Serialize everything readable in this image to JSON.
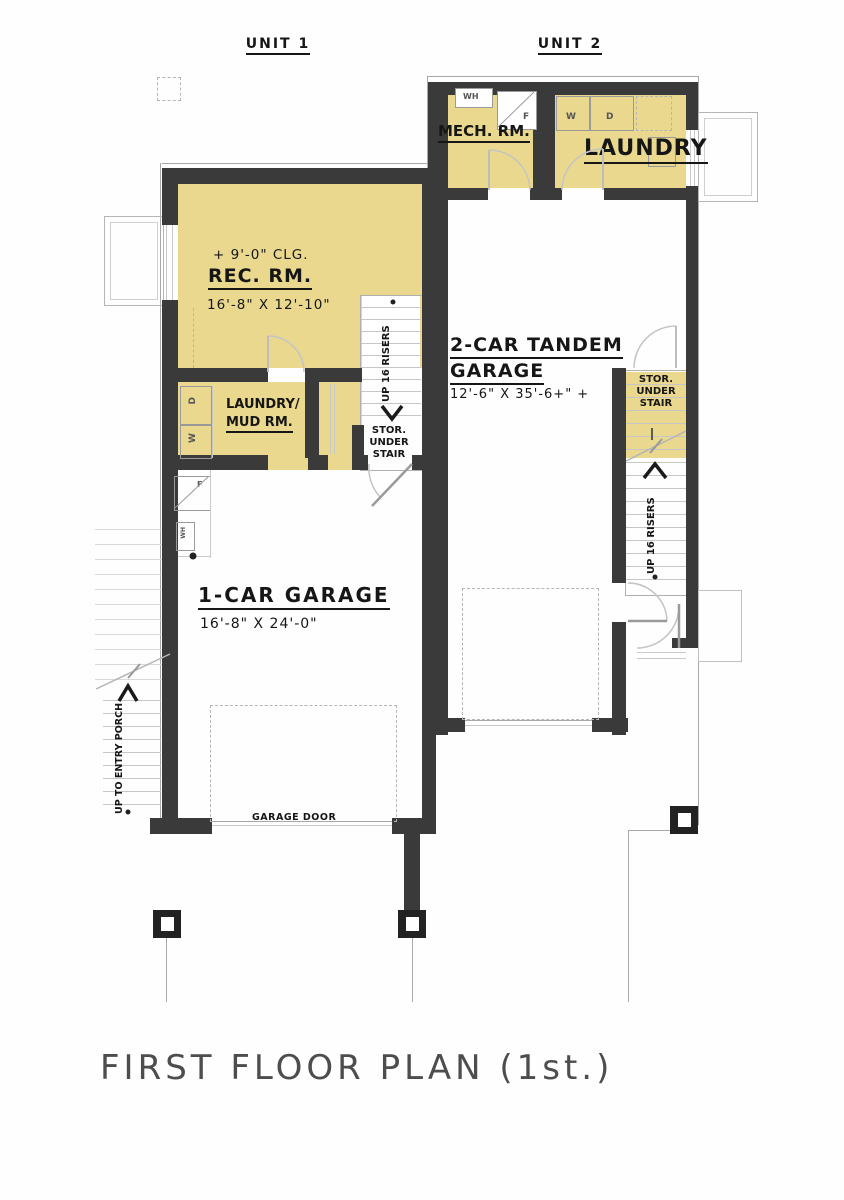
{
  "title": {
    "text": "FIRST FLOOR PLAN (1st.)"
  },
  "units": {
    "unit1": "UNIT 1",
    "unit2": "UNIT 2"
  },
  "rooms": {
    "rec": {
      "ceiling": "+ 9'-0\" CLG.",
      "name": "REC. RM.",
      "dims": "16'-8\" X 12'-10\""
    },
    "mud": {
      "line1": "LAUNDRY/",
      "line2": "MUD RM."
    },
    "mech": {
      "name": "MECH. RM."
    },
    "laundry": {
      "name": "LAUNDRY"
    },
    "garage1": {
      "name": "1-CAR GARAGE",
      "dims": "16'-8\" X 24'-0\""
    },
    "garage2": {
      "line1": "2-CAR TANDEM",
      "line2": "GARAGE",
      "dims": "12'-6\" X 35'-6+\" +"
    }
  },
  "stairs": {
    "left": {
      "run": "UP 16 RISERS",
      "stor1": "STOR.",
      "stor2": "UNDER",
      "stor3": "STAIR"
    },
    "right": {
      "run": "UP 16 RISERS",
      "stor1": "STOR.",
      "stor2": "UNDER",
      "stor3": "STAIR"
    },
    "porch": {
      "run": "UP TO ENTRY PORCH"
    }
  },
  "labels": {
    "garage_door": "GARAGE DOOR"
  },
  "appliances": {
    "water_heater": "WH",
    "furnace": "F",
    "washer": "W",
    "dryer": "D",
    "mud_washer": "W",
    "mud_dryer": "D",
    "garage_furnace": "F",
    "garage_water_heater": "WH"
  },
  "colors": {
    "room_fill": "#e9d88e",
    "wall": "#3a3a3a",
    "line": "#a8a8a8",
    "light_line": "#c9c9c9",
    "text": "#161616",
    "title": "#4d4d4d"
  }
}
